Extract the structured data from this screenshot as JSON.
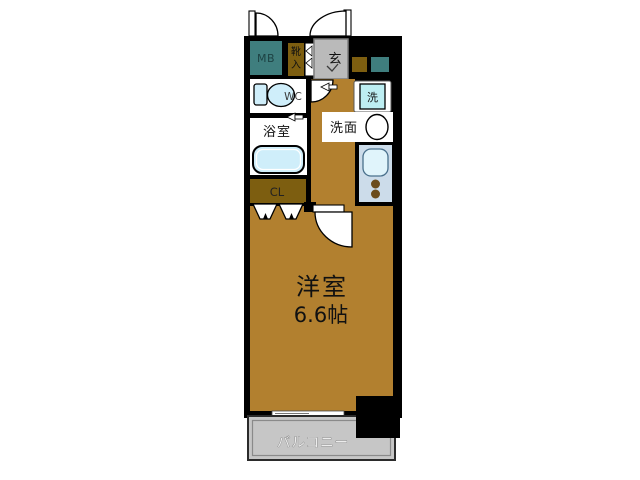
{
  "floor_plan": {
    "rooms": {
      "meter_box": {
        "label": "MB"
      },
      "shoe_storage": {
        "chars": [
          "靴",
          "入"
        ]
      },
      "entrance": {
        "label": "玄"
      },
      "toilet": {
        "label": "WC"
      },
      "bathroom": {
        "label": "浴室"
      },
      "washing_machine": {
        "label": "洗"
      },
      "washroom": {
        "label": "洗面"
      },
      "closet": {
        "label": "CL"
      },
      "main_room": {
        "label": "洋室",
        "size": "6.6帖"
      },
      "balcony": {
        "label": "バルコニー"
      }
    },
    "colors": {
      "wall": "#000000",
      "floor": "#b2802f",
      "meter_box": "#3f7e7e",
      "storage": "#7d5e10",
      "entrance_floor": "#bababa",
      "fixture": "#cfeefa",
      "washer": "#bdeef2",
      "kitchen_panel": "#ccdcea",
      "kitchen_sink": "#e0f4fb",
      "burner": "#6b4c1c",
      "balcony_floor": "#c6c6c6",
      "background": "#ffffff"
    }
  }
}
